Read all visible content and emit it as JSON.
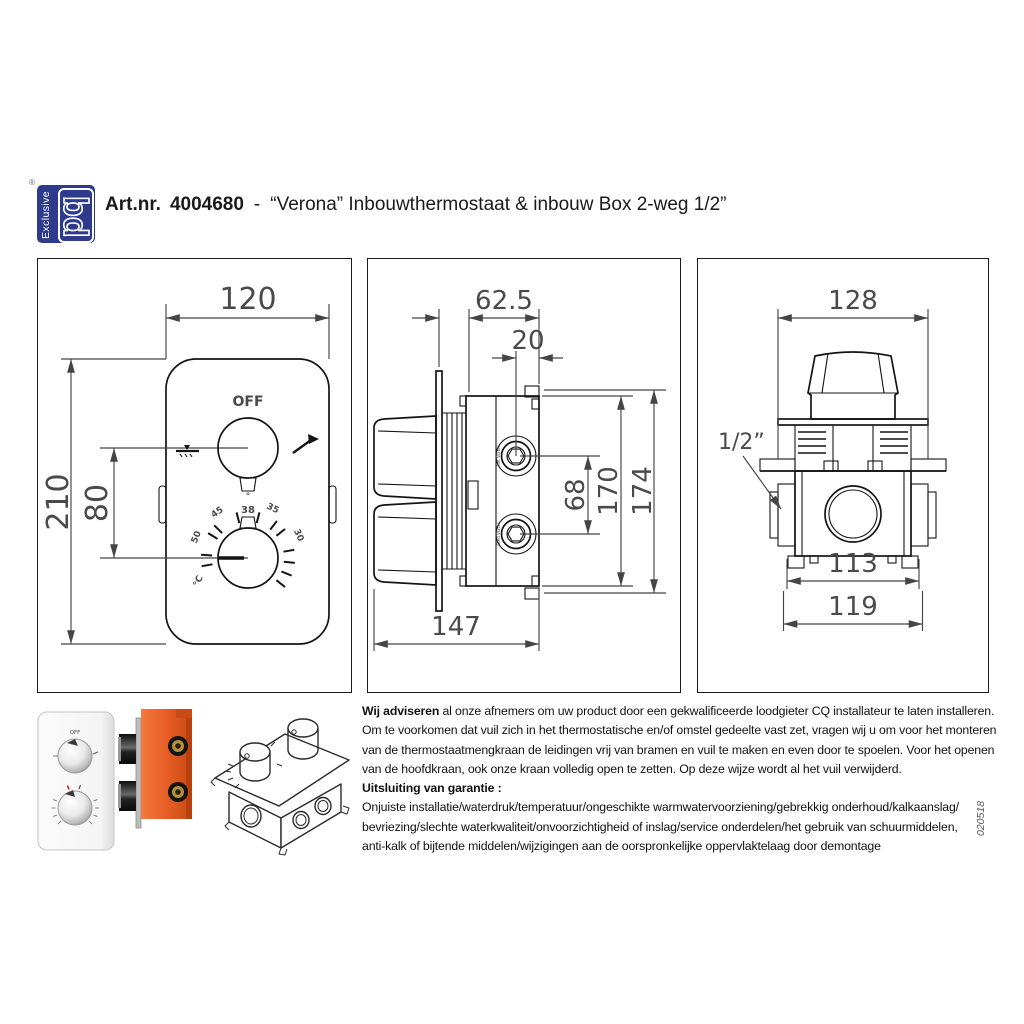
{
  "header": {
    "registered_mark": "®",
    "logo_vertical": "Exclusive",
    "logo_monogram": "bd",
    "brand_color": "#2e3a8c",
    "artnr_label": "Art.nr.",
    "artnr_value": "4004680",
    "title_sep": "-",
    "title": "“Verona” Inbouwthermostaat & inbouw Box 2-weg 1/2”"
  },
  "front_view": {
    "dim_width": "120",
    "dim_height": "210",
    "dim_knob_spacing": "80",
    "off_label": "OFF",
    "temp_scale": {
      "deg": "°",
      "t38": "38",
      "t35": "35",
      "t30": "30",
      "t45": "45",
      "t50": "50",
      "unit": "°C"
    }
  },
  "side_view": {
    "dim_box_depth": "62.5",
    "dim_port_offset": "20",
    "dim_port_spacing": "68",
    "dim_box_height": "170",
    "dim_total_height": "174",
    "dim_total_depth": "147",
    "port_top_label": "Hot Water",
    "port_bottom_label": "Cold Water"
  },
  "back_view": {
    "dim_plate_width": "128",
    "dim_body_width": "113",
    "dim_flange_width": "119",
    "connection_label": "1/2”"
  },
  "photos": {
    "front_plate_off": "OFF"
  },
  "footer": {
    "advice_bold": "Wij adviseren",
    "advice_line1_rest": " al onze afnemers om uw product door een gekwalificeerde loodgieter CQ installateur te laten installeren.",
    "advice_line2": "Om te voorkomen dat vuil zich in het thermostatische en/of omstel gedeelte vast zet, vragen wij u om voor het monteren",
    "advice_line3": "van  de thermostaatmengkraan de leidingen vrij van bramen en vuil te maken en even door te spoelen. Voor het openen",
    "advice_line4": "van de hoofdkraan, ook onze kraan volledig open te zetten. Op deze wijze wordt al het vuil verwijderd.",
    "warranty_title": "Uitsluiting van garantie :",
    "warranty_line1": "Onjuiste installatie/waterdruk/temperatuur/ongeschikte warmwatervoorziening/gebrekkig onderhoud/kalkaanslag/",
    "warranty_line2": "bevriezing/slechte waterkwaliteit/onvoorzichtigheid of inslag/service onderdelen/het gebruik van schuurmiddelen,",
    "warranty_line3": "anti-kalk of bijtende middelen/wijzigingen aan de oorspronkelijke oppervlaktelaag  door demontage",
    "doc_code": "020518"
  }
}
